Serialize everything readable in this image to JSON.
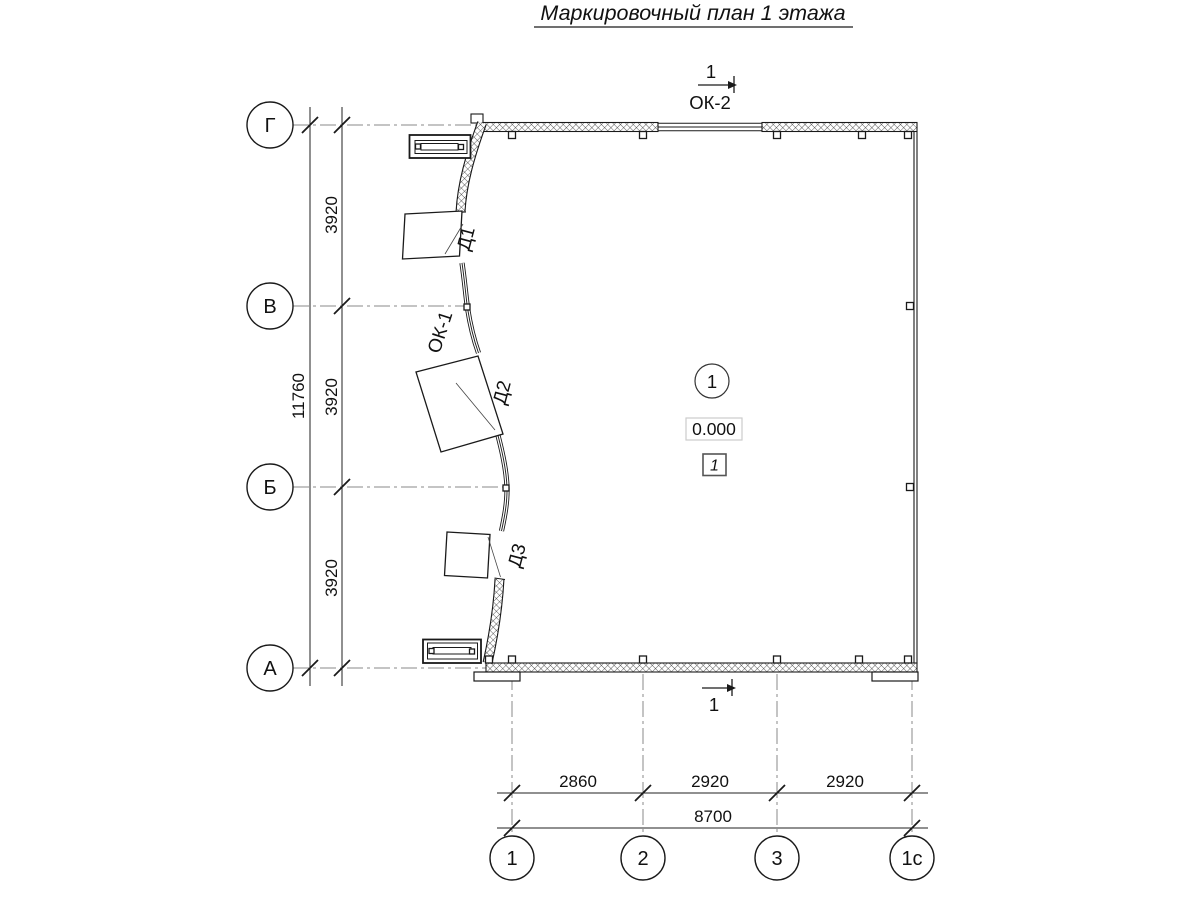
{
  "title": "Маркировочный план 1 этажа",
  "grid": {
    "rows": [
      {
        "label": "Г"
      },
      {
        "label": "В"
      },
      {
        "label": "Б"
      },
      {
        "label": "А"
      }
    ],
    "cols": [
      {
        "label": "1"
      },
      {
        "label": "2"
      },
      {
        "label": "3"
      },
      {
        "label": "1с"
      }
    ]
  },
  "dims": {
    "row_spans": [
      "3920",
      "3920",
      "3920"
    ],
    "row_total": "11760",
    "col_spans": [
      "2860",
      "2920",
      "2920"
    ],
    "col_total": "8700"
  },
  "sections": {
    "top": "1",
    "bottom": "1"
  },
  "openings": {
    "window_top": "ОК-2",
    "window_left": "ОК-1",
    "door1": "Д1",
    "door2": "Д2",
    "door3": "Д3"
  },
  "room": {
    "number": "1",
    "elevation": "0.000",
    "floor_mark": "1"
  },
  "colors": {
    "line": "#1a1a1a",
    "axis": "#8a8a8a",
    "dim": "#222222",
    "elev_border": "#cccccc",
    "bg": "#ffffff"
  }
}
